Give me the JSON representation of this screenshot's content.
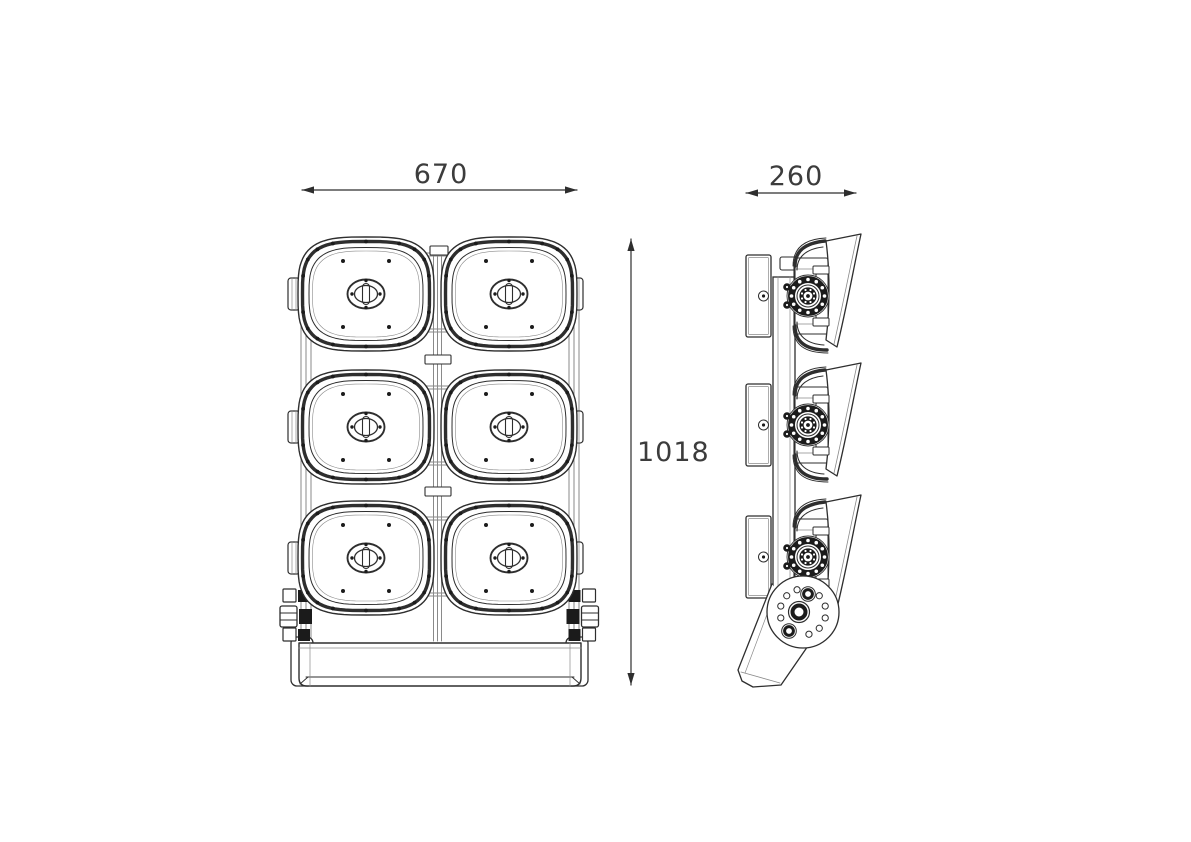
{
  "drawing": {
    "type": "technical-orthographic-drawing",
    "subject": "LED floodlight fixture - front and side elevations",
    "views": [
      {
        "id": "front-view",
        "module_rows": 3,
        "module_columns": 2,
        "module_count": 6
      },
      {
        "id": "side-view",
        "module_count": 3
      }
    ],
    "dimensions": {
      "width": {
        "label": "670"
      },
      "depth": {
        "label": "260"
      },
      "height": {
        "label": "1018"
      }
    },
    "style": {
      "background": "#ffffff",
      "line_color": "#2e2e2e",
      "thin_line_color": "#8a8a8a",
      "dark_fill": "#1b1b1b",
      "text_color": "#3c3c3c",
      "dim_font_size": 27
    }
  }
}
